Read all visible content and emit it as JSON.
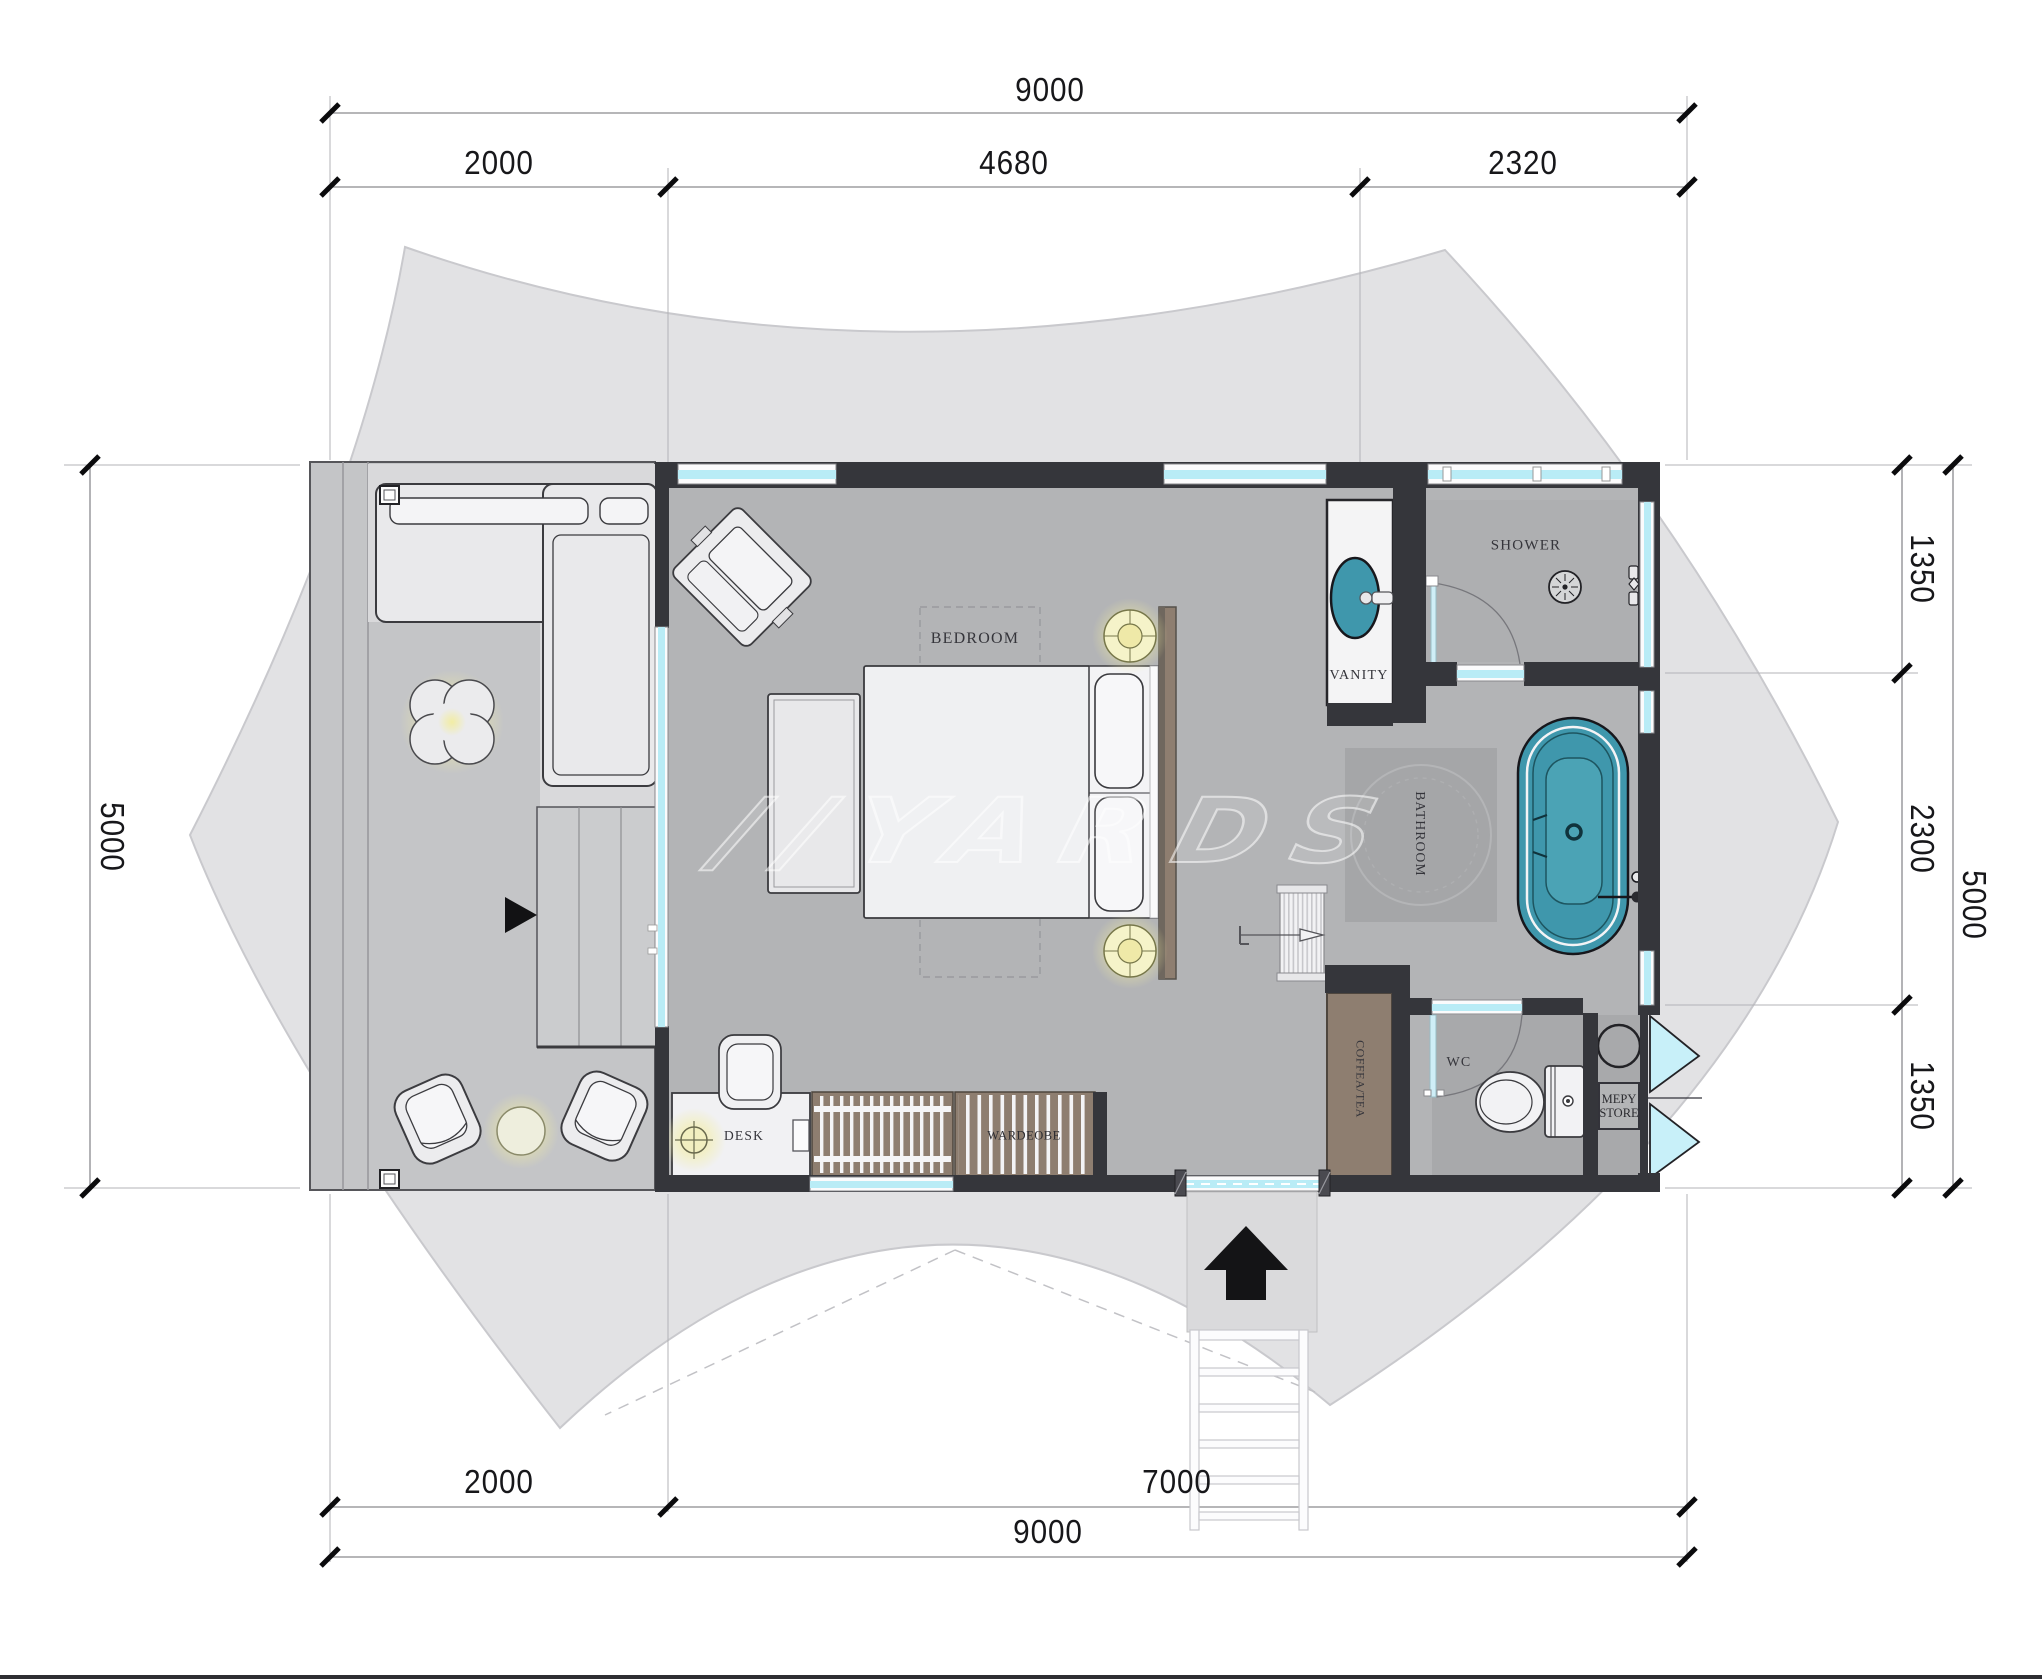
{
  "plan": {
    "title": "tent-suite-floor-plan",
    "watermark_prefix": "//",
    "watermark": "YARDS",
    "rooms": {
      "bedroom": "BEDROOM",
      "vanity": "VANITY",
      "shower": "SHOWER",
      "bathroom": "BATHROOM",
      "wc": "WC",
      "mep_store_line1": "MEPY",
      "mep_store_line2": "STORE",
      "coffee_tea": "COFFEA/TEA",
      "desk": "DESK",
      "wardrobe": "WARDEOBE"
    },
    "dimensions": {
      "top_total": "9000",
      "top_segments": [
        "2000",
        "4680",
        "2320"
      ],
      "bottom_segments": [
        "2000",
        "7000"
      ],
      "bottom_total": "9000",
      "left_total": "5000",
      "right_segments": [
        "1350",
        "2300",
        "1350"
      ],
      "right_total": "5000"
    },
    "colors": {
      "wall": "#35363b",
      "glass": "#b9ecf6",
      "fixture_teal": "#3f97ac",
      "wood": "#8e7e70",
      "lamp_glow": "#f3efa2",
      "canvas": "#e2e2e4",
      "floor": "#b3b4b6"
    }
  }
}
